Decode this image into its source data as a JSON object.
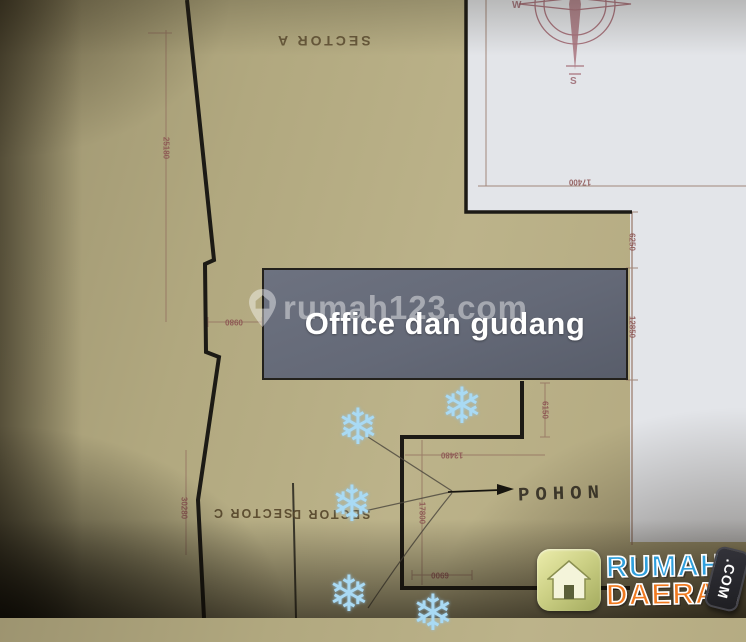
{
  "watermark": {
    "icon": "location-pin-icon",
    "text": "rumah123.com"
  },
  "plan": {
    "office_box_label": "Office dan gudang",
    "annotation": {
      "text": "POHON"
    },
    "sectors": {
      "a": "SECTOR A",
      "c": "SECTOR C",
      "d": "SECTOR D"
    },
    "dimensions": {
      "left_upper": "25180",
      "left_lower": "30280",
      "notch_width": "0980",
      "top_right": "17400",
      "right_upper": "6250",
      "right_lower": "12850",
      "step_height": "6150",
      "step_width": "13480",
      "lower_height": "17800",
      "lower_width": "6900"
    },
    "compass": {
      "west": "W",
      "south": "S"
    },
    "tree_glyph": "❄",
    "tree_count": 5
  },
  "logo": {
    "line1": "RUMAH",
    "line2": "DAERAH",
    "badge": ".COM",
    "icon": "house-icon"
  },
  "colors": {
    "paper": "#b1a87f",
    "white_area": "#e3e5e9",
    "office_box": "#646977",
    "tree": "#a9daf4",
    "logo_blue": "#2f9fdc",
    "logo_orange": "#f0791f",
    "dimension_text": "#8a5050"
  }
}
